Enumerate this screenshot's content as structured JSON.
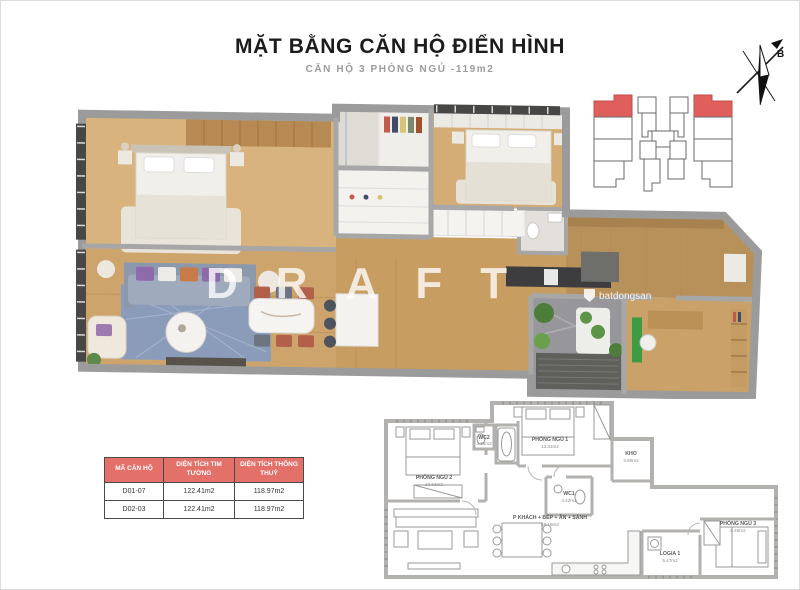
{
  "header": {
    "title": "MẶT BẰNG CĂN HỘ ĐIỂN HÌNH",
    "subtitle": "CĂN HỘ 3 PHÒNG NGỦ -119m2"
  },
  "compass": {
    "north_label": "B"
  },
  "watermark": {
    "draft_text": "DRAFT",
    "site_text": "batdongsan"
  },
  "unit_table": {
    "headers": [
      "MÃ CĂN HỘ",
      "DIỆN TÍCH TIM TƯỜNG",
      "DIỆN TÍCH THÔNG THUỶ"
    ],
    "rows": [
      {
        "code": "D01-07",
        "gross": "122.41m2",
        "net": "118.97m2"
      },
      {
        "code": "D02-03",
        "gross": "122.41m2",
        "net": "118.97m2"
      }
    ]
  },
  "floorplan_2d": {
    "rooms": [
      {
        "name": "PHÒNG NGỦ 2",
        "area": "10.93m2"
      },
      {
        "name": "WC2",
        "area": "3.35m2"
      },
      {
        "name": "PHÒNG NGỦ 1",
        "area": "13.31m2"
      },
      {
        "name": "WC1",
        "area": "4.42m2"
      },
      {
        "name": "KHO",
        "area": "3.60m2"
      },
      {
        "name": "P KHÁCH + BẾP + ĂN + SẢNH",
        "area": "58.19m2"
      },
      {
        "name": "LOGIA 1",
        "area": "5.47m2"
      },
      {
        "name": "PHÒNG NGỦ 3",
        "area": "8.45m2"
      }
    ]
  },
  "colors": {
    "table_header_bg": "#e4706a",
    "highlight_unit": "#e05e5c"
  }
}
